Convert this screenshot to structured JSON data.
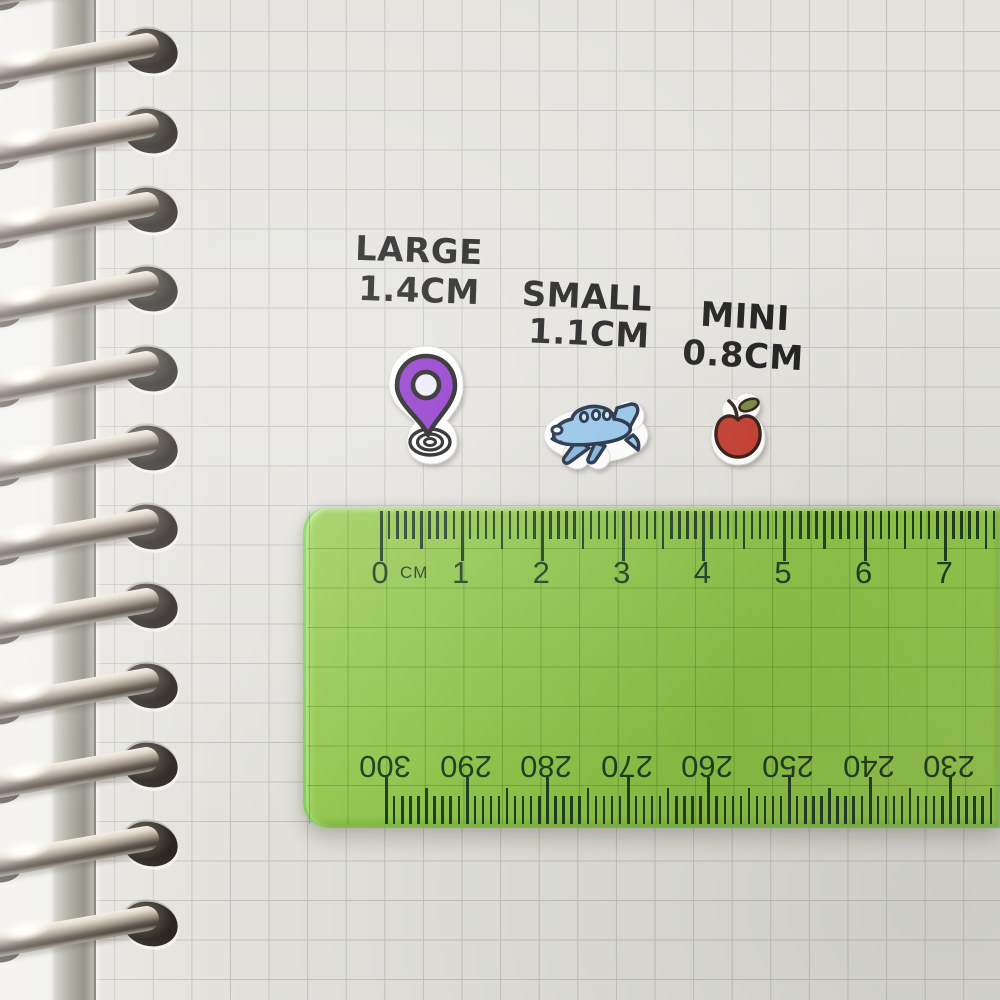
{
  "size_labels": [
    {
      "name": "large",
      "line1": "LARGE",
      "line2": "1.4CM"
    },
    {
      "name": "small",
      "line1": "SMALL",
      "line2": "1.1CM"
    },
    {
      "name": "mini",
      "line1": "MINI",
      "line2": "0.8CM"
    }
  ],
  "stickers": [
    {
      "name": "location-pin",
      "size": "1.4CM",
      "color": "#8a2ec9"
    },
    {
      "name": "airplane",
      "size": "1.1CM",
      "color": "#93c4ea"
    },
    {
      "name": "apple",
      "size": "0.8CM",
      "color": "#c23527"
    }
  ],
  "ruler": {
    "unit_label": "CM",
    "top_scale_labels": [
      "0",
      "1",
      "2",
      "3",
      "4",
      "5",
      "6",
      "7"
    ],
    "bottom_scale_labels": [
      "300",
      "290",
      "280",
      "270",
      "260",
      "250",
      "240",
      "230"
    ]
  },
  "colors": {
    "paper": "#e3e2dd",
    "grid_line": "#b1b0ab",
    "label_ink": "#171717",
    "ruler_green": "#8ec747",
    "ruler_ink": "#1c3a1e",
    "pin_purple": "#8a2ec9",
    "plane_blue": "#93c4ea",
    "plane_blue_dark": "#7fb2dd",
    "apple_red": "#c23527",
    "leaf_green": "#75833a"
  }
}
